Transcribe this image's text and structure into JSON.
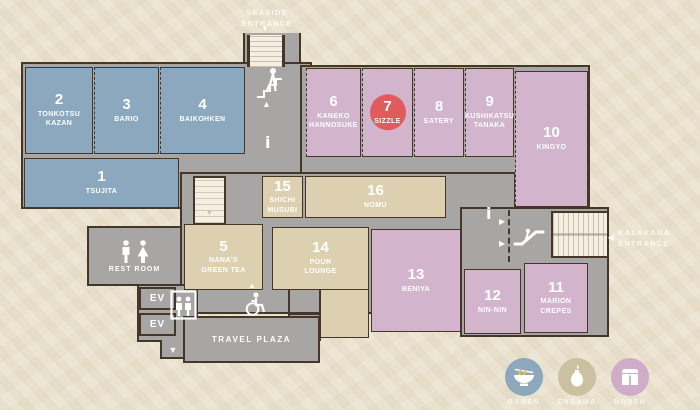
{
  "colors": {
    "background": "#ece4d1",
    "floor": "#a7a6a4",
    "wall": "#44372a",
    "ramen_units": "#8ca8be",
    "engawa_units": "#dcd0b0",
    "noren_units": "#d2b5cc",
    "highlight_circle": "#e05c5c",
    "noodle_yellow": "#e9c53e"
  },
  "entrances": {
    "seaside": {
      "line1": "SEASIDE",
      "line2": "ENTRANCE"
    },
    "kalakaua": {
      "line1": "KALAKAUA",
      "line2": "ENTRANCE"
    }
  },
  "highlight": {
    "unit_number": "7",
    "unit_name": "SIZZLE"
  },
  "units": [
    {
      "number": "1",
      "name": "TSUJITA",
      "category": "ramen"
    },
    {
      "number": "2",
      "name": "TONKOTSU KAZAN",
      "category": "ramen"
    },
    {
      "number": "3",
      "name": "BARIO",
      "category": "ramen"
    },
    {
      "number": "4",
      "name": "BAIKOHKEN",
      "category": "ramen"
    },
    {
      "number": "5",
      "name": "NANA'S GREEN TEA",
      "category": "engawa"
    },
    {
      "number": "6",
      "name": "KANEKO HANNOSUKE",
      "category": "noren"
    },
    {
      "number": "7",
      "name": "SIZZLE",
      "category": "noren",
      "highlighted": true
    },
    {
      "number": "8",
      "name": "EATERY",
      "category": "noren"
    },
    {
      "number": "9",
      "name": "KUSHIKATSU TANAKA",
      "category": "noren"
    },
    {
      "number": "10",
      "name": "KINGYO",
      "category": "noren"
    },
    {
      "number": "11",
      "name": "MARION CREPES",
      "category": "noren"
    },
    {
      "number": "12",
      "name": "NIN-NIN",
      "category": "noren"
    },
    {
      "number": "13",
      "name": "BENIYA",
      "category": "noren"
    },
    {
      "number": "14",
      "name": "POUR LOUNGE",
      "category": "engawa"
    },
    {
      "number": "15",
      "name": "SHICHI MUSUBI",
      "category": "engawa"
    },
    {
      "number": "16",
      "name": "NOMU",
      "category": "engawa"
    }
  ],
  "facilities": {
    "rest_room": "REST ROOM",
    "ev_upper": "EV",
    "ev_lower": "EV",
    "travel_plaza": "TRAVEL PLAZA"
  },
  "legend": {
    "items": [
      {
        "label": "RAMEN",
        "color": "#8da7bc",
        "icon": "ramen-bowl-icon"
      },
      {
        "label": "ENGAWA",
        "color": "#cbc0a0",
        "icon": "sake-bottle-icon"
      },
      {
        "label": "NOREN",
        "color": "#cfadc8",
        "icon": "noren-curtain-icon"
      }
    ]
  },
  "icons": {
    "down_triangle": "▼",
    "up_triangle": "▲",
    "left_triangle": "◀",
    "right_triangle": "▶",
    "stairs_triangle": "▼"
  }
}
